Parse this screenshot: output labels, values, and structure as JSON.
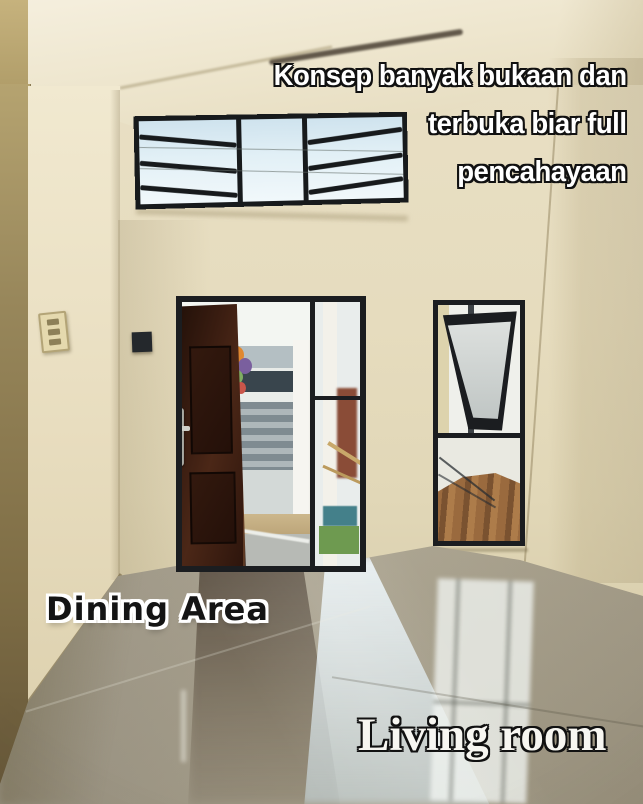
{
  "caption": {
    "lines": [
      "Konsep banyak bukaan dan",
      "terbuka biar full",
      "pencahayaan"
    ]
  },
  "labels": {
    "dining": "Dining Area",
    "living": "Living room"
  },
  "palette": {
    "wall_cream": "#e6dcbe",
    "wall_olive": "#8a7a4e",
    "ceiling": "#f2ecda",
    "sky_glass": "#d8eaf2",
    "frame_black": "#1b1d20",
    "door_brown": "#3a1d11",
    "floor_taupe": "#aba390",
    "reflection_blue": "#d6e5ec",
    "outside_fence_gray": "#8b969c",
    "outside_ground_tan": "#c6b186",
    "dirt_brown": "#9a6a3e"
  }
}
